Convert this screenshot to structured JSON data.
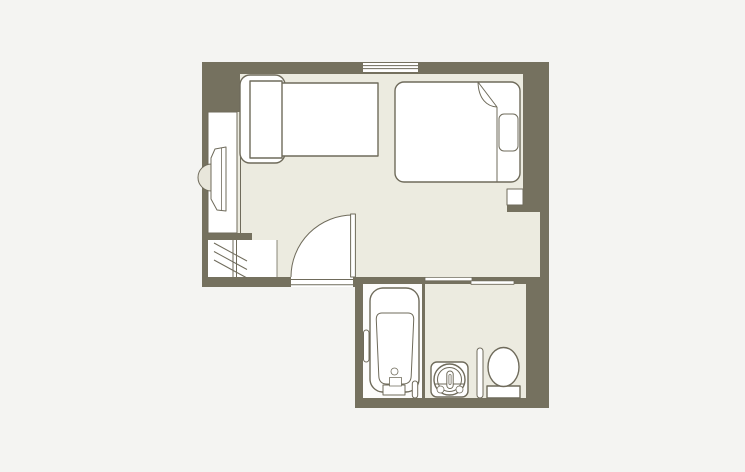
{
  "colors": {
    "background": "#f4f4f2",
    "wall": "#75715f",
    "floor": "#ecebe0",
    "wet_floor": "#fcfcfb",
    "fixture_fill": "#ffffff",
    "line": "#6f6b5b",
    "stool_fill": "#e8e6db"
  },
  "plan": {
    "rooms": [
      "bedroom",
      "entrance",
      "bathtub-room",
      "vanity-toilet-area"
    ],
    "fixtures": [
      "single-bed",
      "double-bed",
      "desk-with-stool",
      "wardrobe-rail",
      "entry-door",
      "window",
      "sliding-doors",
      "bathtub",
      "washbasin",
      "toilet",
      "wall-niche-shelf",
      "nightstand-niche"
    ]
  }
}
